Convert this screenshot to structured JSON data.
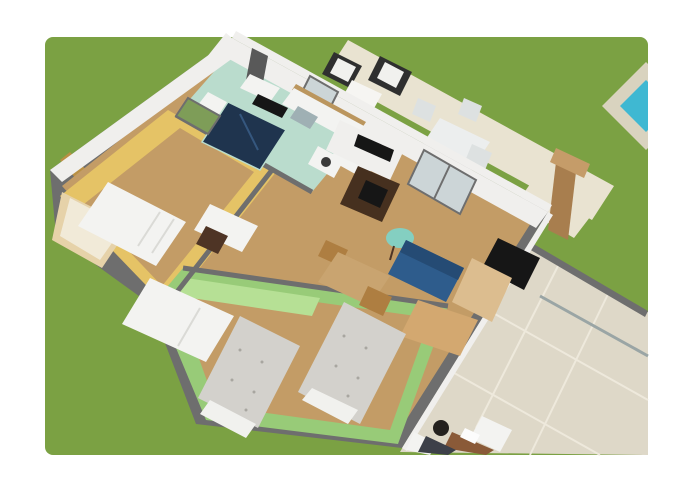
{
  "scene": {
    "type": "3d-floorplan-render",
    "rooms": [
      "kitchen",
      "bathroom",
      "bedroom-yellow",
      "bedroom-green",
      "living-room",
      "veranda",
      "garden"
    ]
  },
  "colors": {
    "grass": "#7ba143",
    "poolDeck": "#d9d3bf",
    "poolWater": "#3fb8d2",
    "patio": "#e9e3d1",
    "beamWood": "#a87e4e",
    "beamWoodLight": "#c59c69",
    "chairFrame": "#2f2f2f",
    "cushion": "#f1f1ee",
    "cream": "#f6f5f2",
    "outdoorTable": "#eceeee",
    "outdoorChair": "#dde1e1",
    "terrace": "#ded8c8",
    "terraceLine": "#eee9dc",
    "glassFrame": "#9aa5a5",
    "wall": "#6e6e6e",
    "wallFace": "#f0efed",
    "woodFloor": "#c39c66",
    "mintFloor": "#badccd",
    "yellowWall": "#e5c366",
    "mustard": "#b99044",
    "greenWall": "#98cb78",
    "greenRug": "#b6e095",
    "navy": "#1f344e",
    "navyLight": "#35577e",
    "chimney": "#595959",
    "white": "#f3f3f1",
    "shelfLine": "#dadad6",
    "counterWood": "#bb965e",
    "black": "#161616",
    "steel": "#9fb0b4",
    "washerDoor": "#3a3a3a",
    "glassDoor": "#ccd5d7",
    "windowGreen": "#7e9d58",
    "stove": "#46301f",
    "tealTable": "#84cfc1",
    "tableWood": "#c9a470",
    "chairWood": "#ae7e41",
    "chairDark": "#4e3425",
    "sofa": "#2e5c8c",
    "sofaDark": "#254b74",
    "bedWood": "#e6d2a9",
    "creamBed": "#f1ead8",
    "bedFabric": "#d3d1cc",
    "bedDot": "#a8a6a0",
    "sideboard": "#dcbd8f",
    "crate": "#d3a870",
    "deskWood": "#8a5a38",
    "person": "#24211e",
    "personShirt": "#3d4049",
    "paper": "#fcfcfc"
  }
}
